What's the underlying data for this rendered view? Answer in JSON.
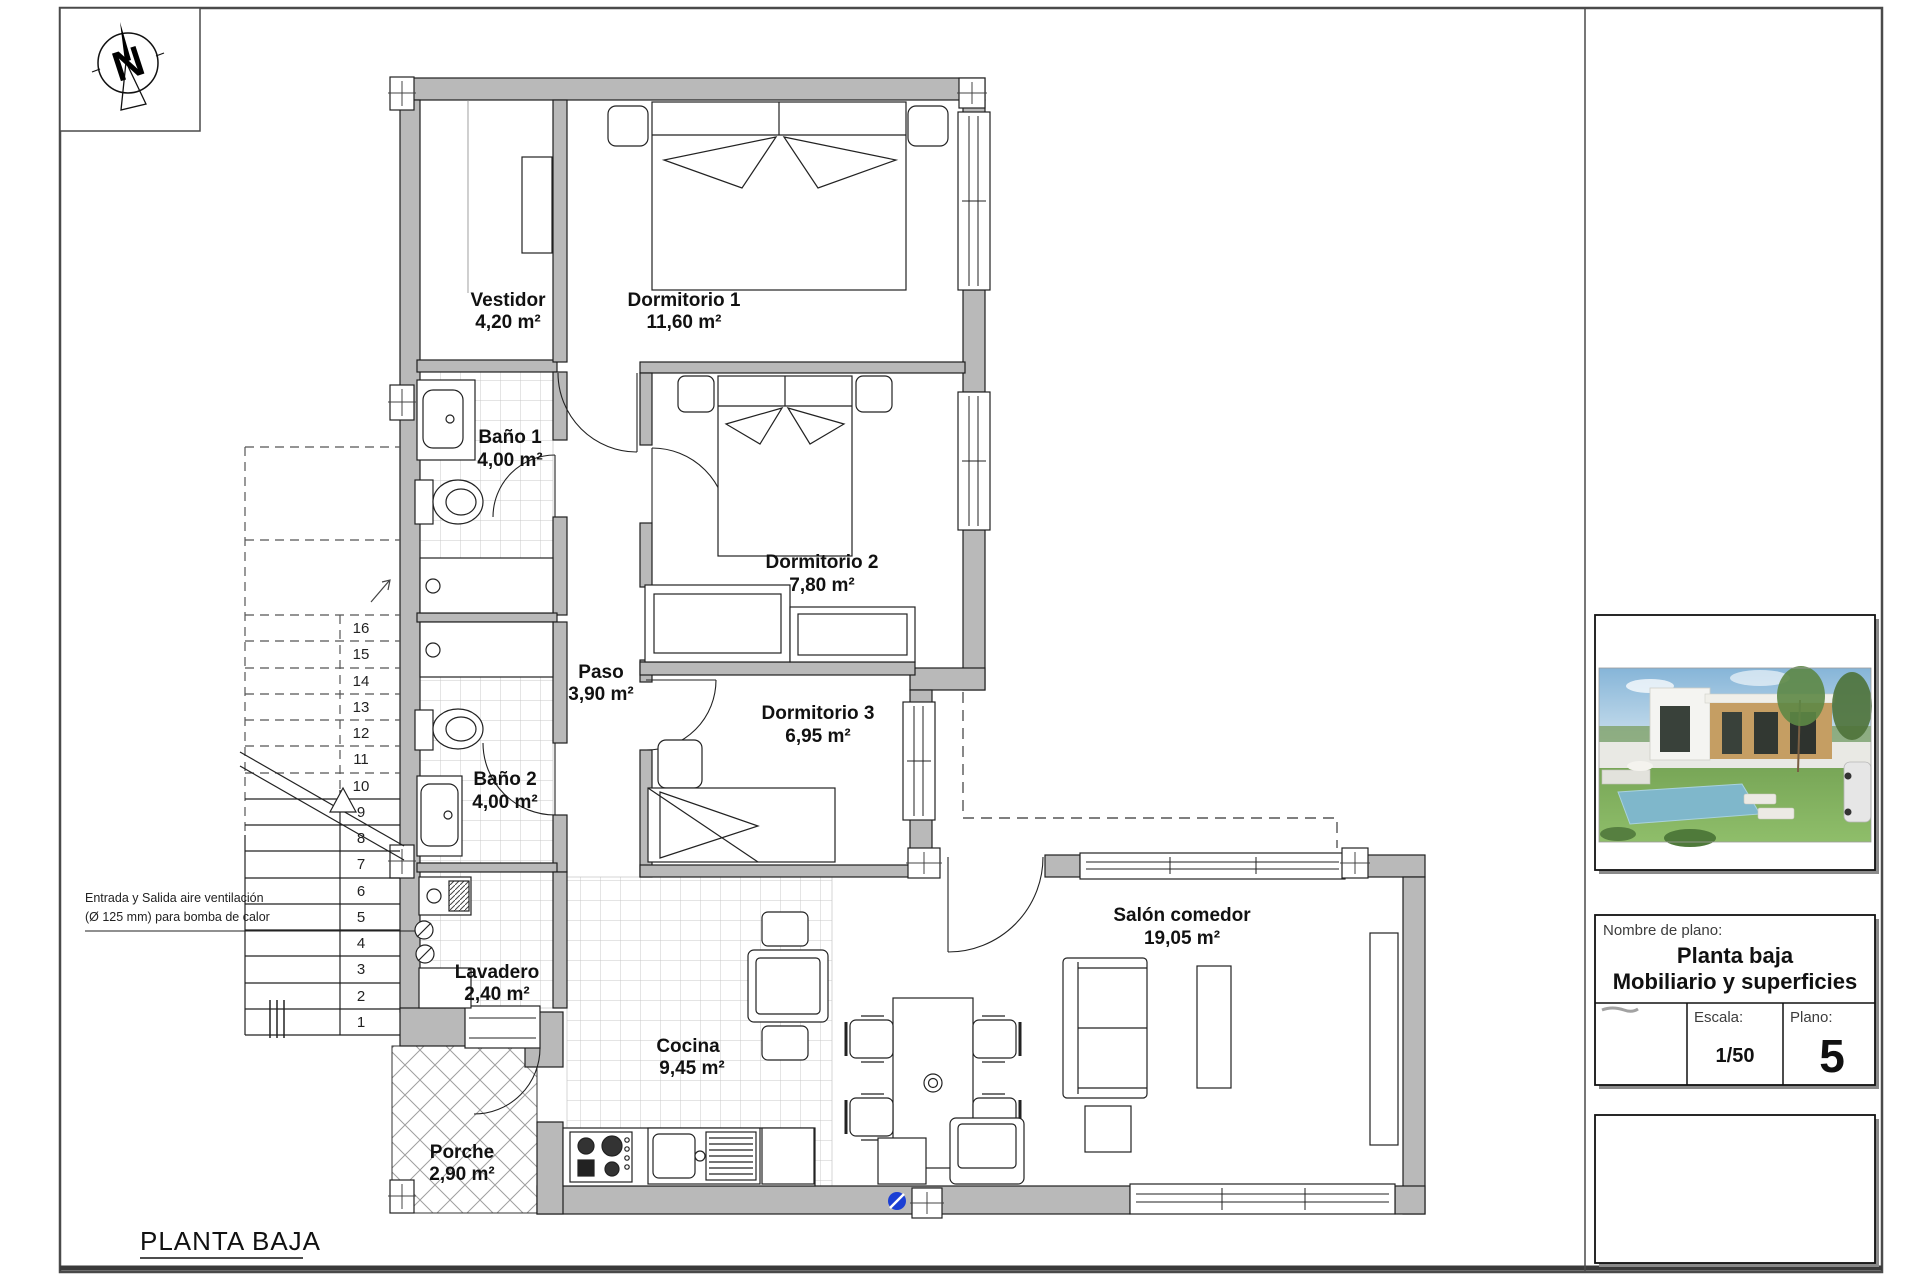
{
  "sheet": {
    "title": "PLANTA BAJA"
  },
  "compass": {
    "letter": "N"
  },
  "rooms": {
    "vestidor": {
      "name": "Vestidor",
      "area": "4,20 m²"
    },
    "dorm1": {
      "name": "Dormitorio 1",
      "area": "11,60 m²"
    },
    "bano1": {
      "name": "Baño 1",
      "area": "4,00 m²"
    },
    "dorm2": {
      "name": "Dormitorio 2",
      "area": "7,80 m²"
    },
    "paso": {
      "name": "Paso",
      "area": "3,90 m²"
    },
    "dorm3": {
      "name": "Dormitorio 3",
      "area": "6,95 m²"
    },
    "bano2": {
      "name": "Baño 2",
      "area": "4,00 m²"
    },
    "lavadero": {
      "name": "Lavadero",
      "area": "2,40 m²"
    },
    "cocina": {
      "name": "Cocina",
      "area": "9,45 m²"
    },
    "porche": {
      "name": "Porche",
      "area": "2,90 m²"
    },
    "salon": {
      "name": "Salón comedor",
      "area": "19,05 m²"
    }
  },
  "annotations": {
    "vent_line1": "Entrada y Salida aire ventilación",
    "vent_line2": "(Ø 125 mm) para bomba de calor"
  },
  "stairs": {
    "numbers": [
      "16",
      "15",
      "14",
      "13",
      "12",
      "11",
      "10",
      "9",
      "8",
      "7",
      "6",
      "5",
      "4",
      "3",
      "2",
      "1"
    ]
  },
  "title_block": {
    "name_label": "Nombre de plano:",
    "plan_name_line1": "Planta baja",
    "plan_name_line2": "Mobiliario y superficies",
    "scale_label": "Escala:",
    "scale_value": "1/50",
    "plan_number_label": "Plano:",
    "plan_number": "5"
  },
  "colors": {
    "wall": "#b9b9b9",
    "outline": "#1f1f1f",
    "drain_blue": "#1b3fd4"
  }
}
